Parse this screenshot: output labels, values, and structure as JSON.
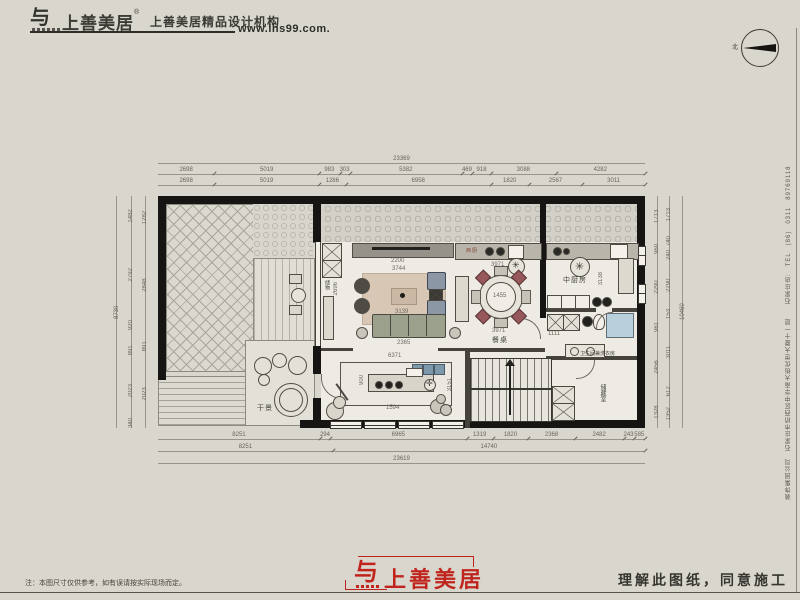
{
  "header": {
    "brand": "上善美居",
    "reg": "®",
    "tagline": "上善美居精品设计机构",
    "url": "www.lhs99.com."
  },
  "compass": {
    "north": "北"
  },
  "side_text": {
    "content": "装饰集团公司　石家庄市桥西区中华南大街优世大厦十一层　　石家庄店:　TEL　(86)　0311　89769118"
  },
  "plan": {
    "room_labels": {
      "storage": "储物",
      "west_kitchen": "西厨",
      "main_kitchen": "中厨房",
      "dining": "餐桌",
      "bath_laundry": "卫生间兼洗衣房",
      "store_room": "储藏室",
      "dry_landscape": "干景"
    },
    "interior_dims": {
      "tv_wall": "2200",
      "rug_width": "3744",
      "rug_inner": "3139",
      "sofa": "2365",
      "living_left_height": "2696",
      "dining_counter": "3971",
      "dining_table_dia": "1455",
      "dining_width": "3971",
      "kitchen_height": "3138",
      "bath_width": "1111",
      "bar_width": "6371",
      "island_depth": "900",
      "bar_window": "1594",
      "bar_height": "3151"
    },
    "dims": {
      "top_total": "23369",
      "top_row_a": [
        "2698",
        "5019",
        "983",
        "303",
        "5382",
        "469",
        "918",
        "3088",
        "4282"
      ],
      "top_row_b": [
        "2698",
        "5019",
        "1286",
        "6958",
        "1820",
        "2567",
        "3011"
      ],
      "bottom_row_a": [
        "8251",
        "294",
        "6965",
        "1319",
        "1820",
        "2368",
        "2482",
        "243",
        "585"
      ],
      "bottom_row_b": [
        "8251",
        "14740"
      ],
      "bottom_total": "23619",
      "left_col_a": [
        "1482",
        "2792",
        "920",
        "891",
        "2023",
        "340"
      ],
      "left_col_b": [
        "1282",
        "2848",
        "891",
        "2023"
      ],
      "left_total": "8730",
      "right_col_a": [
        "1713",
        "960",
        "2290",
        "961",
        "2456",
        "1328"
      ],
      "right_col_b": [
        "1713",
        "740",
        "240",
        "2290",
        "153",
        "3011",
        "612",
        "1352"
      ],
      "right_total": "10460"
    }
  },
  "footer": {
    "note": "注：本图尺寸仅供参考，如有误请按实际现场而定。",
    "logo": "上善美居",
    "statement": "理解此图纸，同意施工"
  }
}
